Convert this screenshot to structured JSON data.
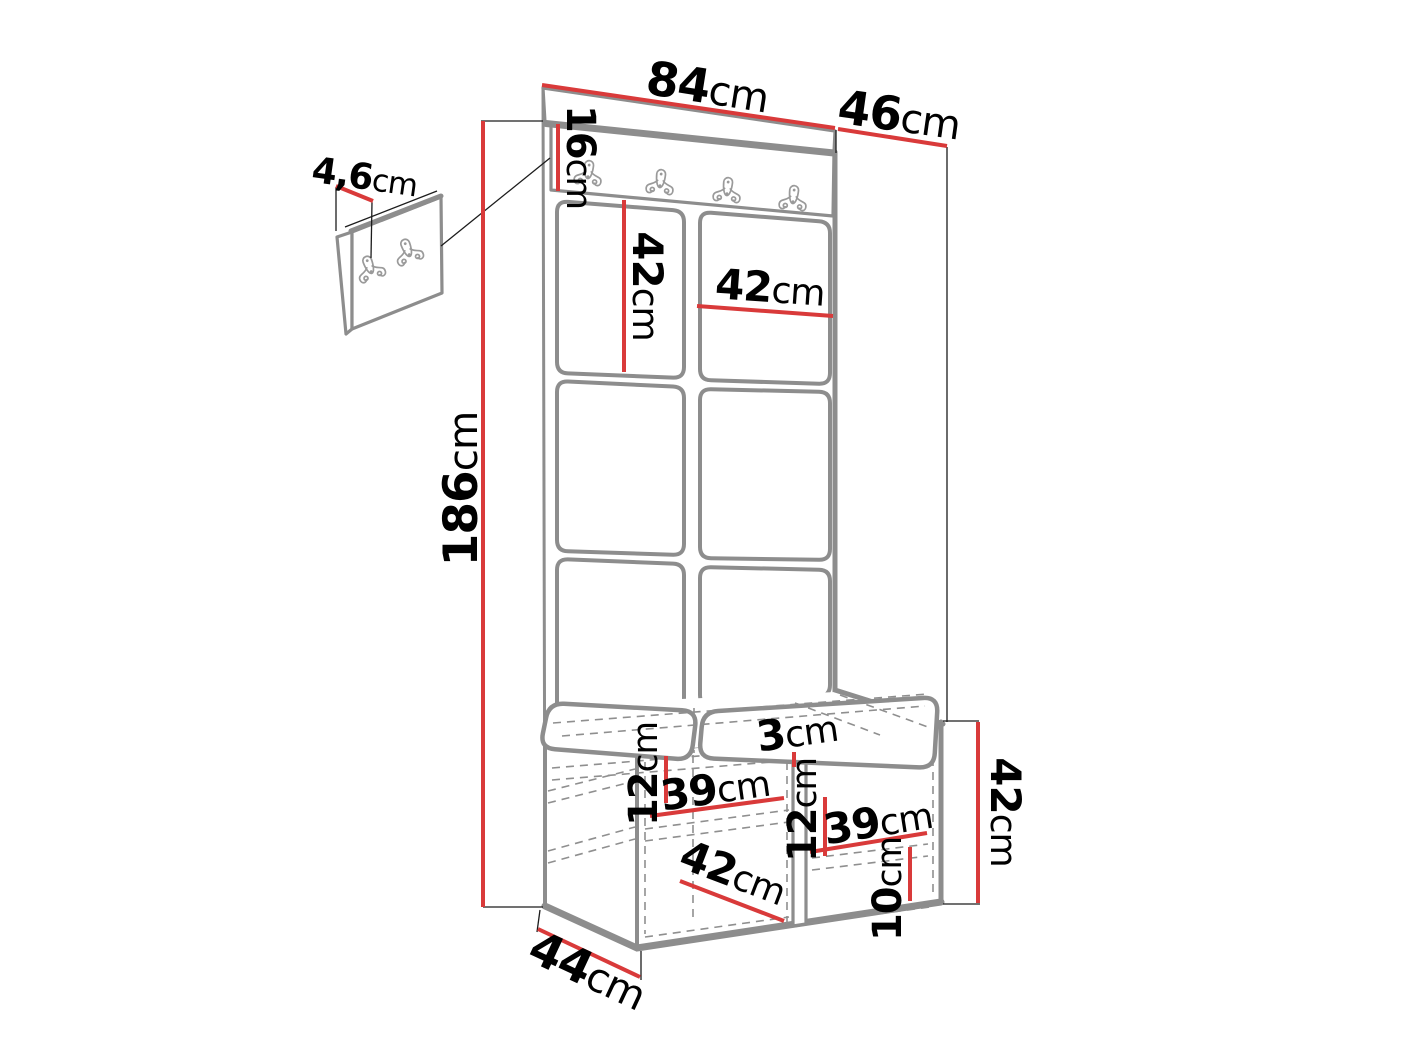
{
  "diagram": {
    "kind": "furniture dimension drawing",
    "colors": {
      "dimension_red": "#d93a3a",
      "outline_gray": "#8d8d8d",
      "hidden_line_gray": "#8f8f8f",
      "text_black": "#000000",
      "background": "#ffffff"
    },
    "dimensions": {
      "top_width": {
        "value": "84",
        "unit": "cm"
      },
      "top_depth": {
        "value": "46",
        "unit": "cm"
      },
      "total_height": {
        "value": "186",
        "unit": "cm"
      },
      "hook_rail_height": {
        "value": "16",
        "unit": "cm"
      },
      "pad_thickness": {
        "value": "4,6",
        "unit": "cm"
      },
      "pad_height": {
        "value": "42",
        "unit": "cm"
      },
      "pad_width": {
        "value": "42",
        "unit": "cm"
      },
      "bench_offset_left": {
        "value": "12",
        "unit": "cm"
      },
      "bench_shelf_left": {
        "value": "39",
        "unit": "cm"
      },
      "bench_divider": {
        "value": "3",
        "unit": "cm"
      },
      "bench_offset_middle": {
        "value": "12",
        "unit": "cm"
      },
      "bench_shelf_right": {
        "value": "39",
        "unit": "cm"
      },
      "bench_plinth_height": {
        "value": "10",
        "unit": "cm"
      },
      "bench_height": {
        "value": "42",
        "unit": "cm"
      },
      "bench_inner_width": {
        "value": "42",
        "unit": "cm"
      },
      "bench_depth": {
        "value": "44",
        "unit": "cm"
      }
    }
  }
}
